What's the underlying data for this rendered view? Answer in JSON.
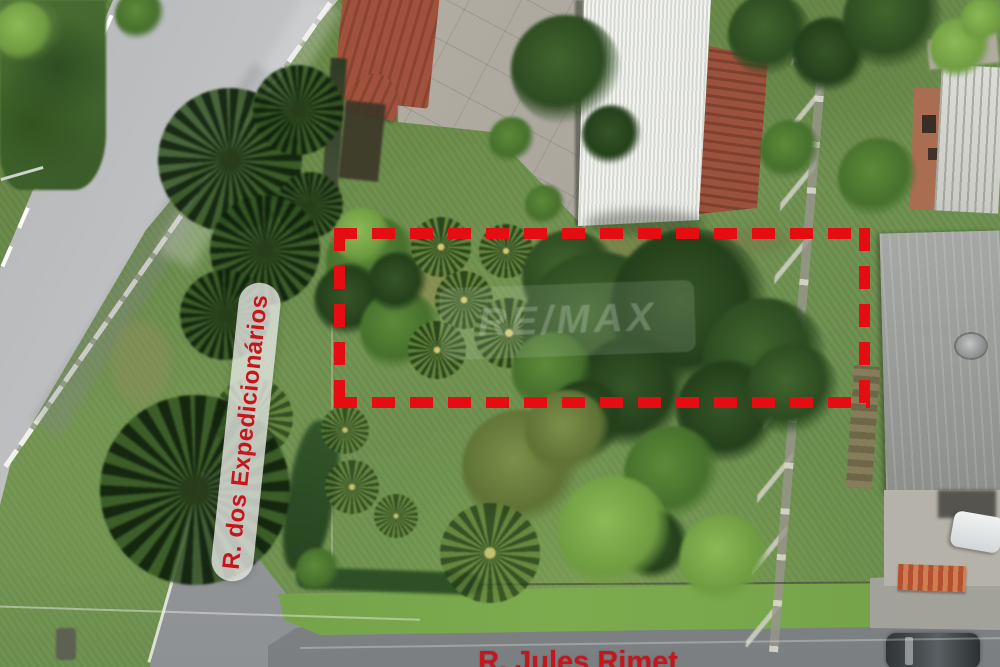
{
  "photo": {
    "kind": "annotated aerial drone photograph of a corner lot",
    "labels": {
      "street_left": "R. dos Expedicionários",
      "street_bottom": "R. Jules Rimet"
    },
    "watermark_text": "RE/MAX"
  },
  "colors": {
    "annotation_red": "#e60d12",
    "street_label_text": "#c8151c",
    "street_label_pill": "rgba(224,227,222,0.82)",
    "grass_base": "#6f9150",
    "road_gray": "#b2b4b6",
    "roof_white": "#e9ebe6",
    "roof_tile": "#96503a",
    "tree_dark": "#2d4b21",
    "tree_bright": "#79a946"
  }
}
